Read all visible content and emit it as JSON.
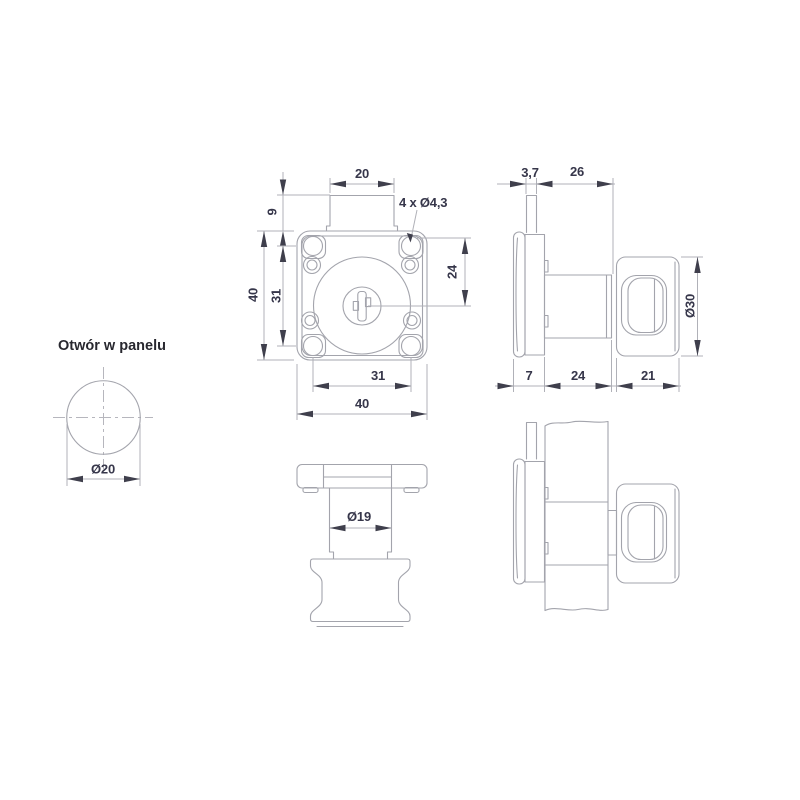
{
  "views": {
    "panel_hole": {
      "title": "Otwór w panelu",
      "dia": "Ø20"
    },
    "front": {
      "tab_width": "20",
      "tab_height": "9",
      "holes_label": "4 x Ø4,3",
      "height": "40",
      "hole_pitch_v": "31",
      "center_offset": "24",
      "hole_pitch_h": "31",
      "width": "40"
    },
    "side": {
      "tab_thickness": "3,7",
      "clamp_depth": "26",
      "knob_dia": "Ø30",
      "flange_depth": "7",
      "cylinder_len": "24",
      "knob_len": "21"
    },
    "top": {
      "cylinder_dia": "Ø19"
    }
  },
  "colors": {
    "outline": "#a3a4ac",
    "dimension": "#b0b1b8",
    "arrow": "#3f3f4c",
    "text": "#36364a",
    "title_text": "#28282f",
    "centerline": "#b6b6bd",
    "background": "#ffffff"
  }
}
